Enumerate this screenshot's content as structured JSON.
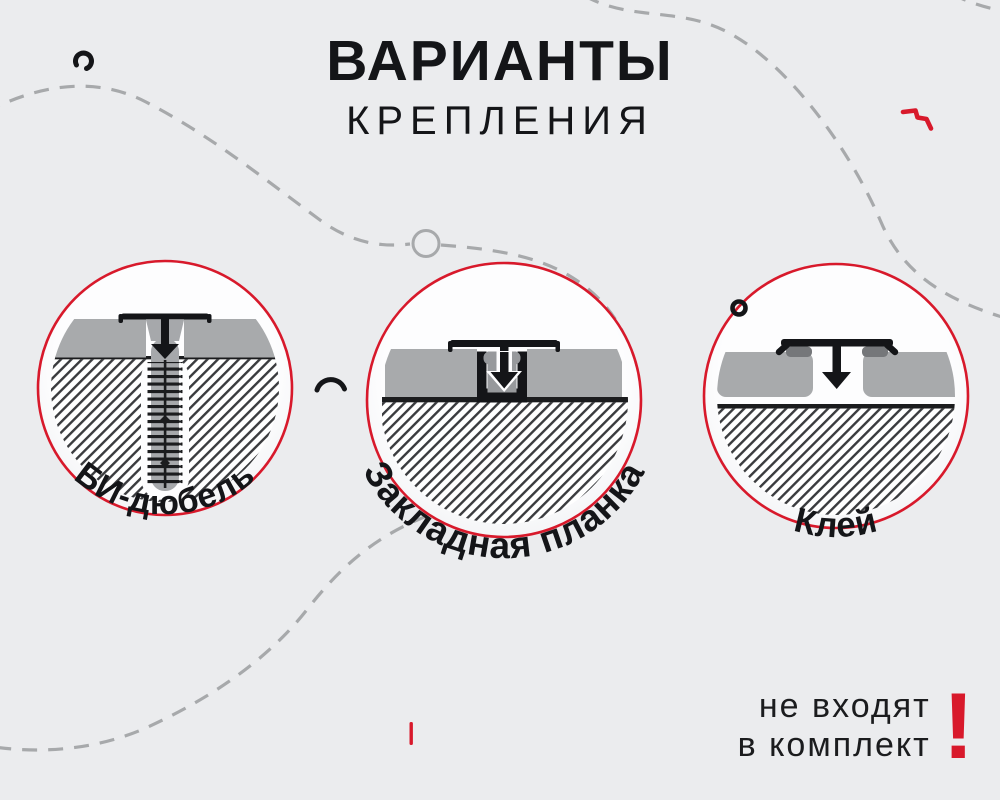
{
  "header": {
    "title": "ВАРИАНТЫ",
    "subtitle": "КРЕПЛЕНИЯ"
  },
  "options": [
    {
      "id": "bi-dowel",
      "label": "БИ-дюбель"
    },
    {
      "id": "embedded-plank",
      "label": "Закладная планка"
    },
    {
      "id": "glue",
      "label": "Клей"
    }
  ],
  "note": {
    "line1": "не входят",
    "line2": "в комплект",
    "mark": "!"
  },
  "colors": {
    "background": "#ebecee",
    "accent_red": "#d8192b",
    "text": "#1b1c1e",
    "panel_gray": "#a8aaac",
    "dash_gray": "#a7a9ab",
    "hatch_line": "#3a3b3e"
  }
}
